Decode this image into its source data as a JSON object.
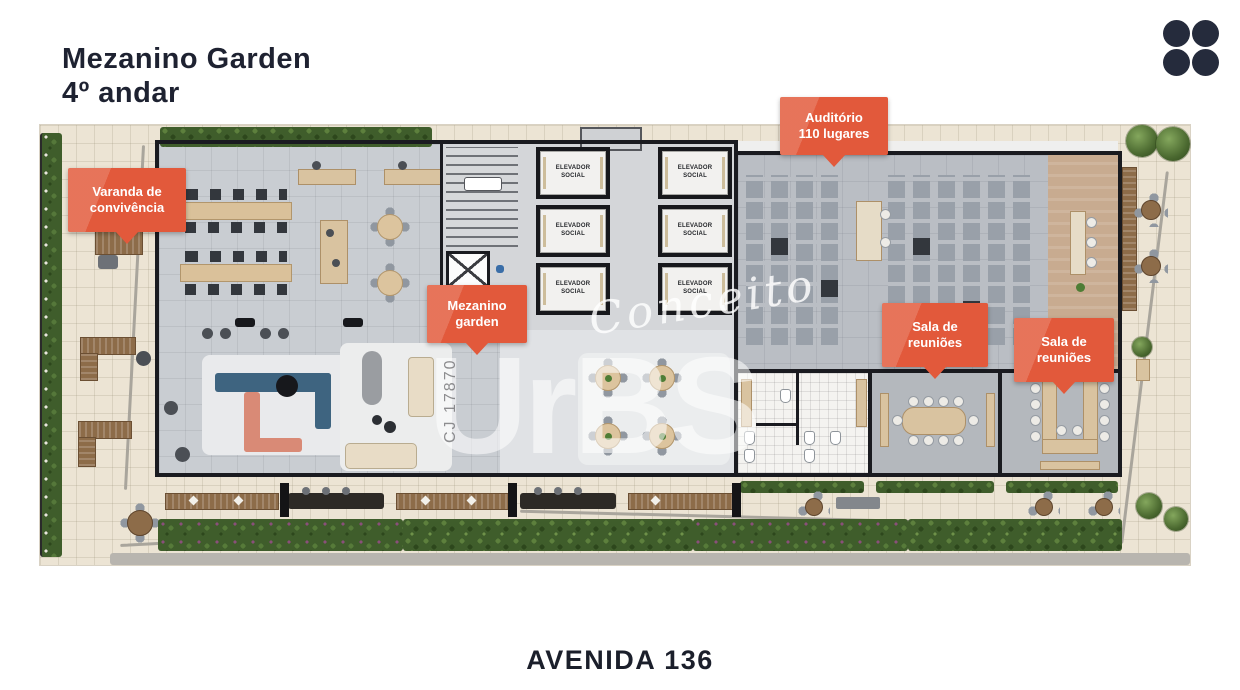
{
  "header": {
    "title_line1": "Mezanino Garden",
    "title_line2": "4º andar"
  },
  "footer": {
    "street": "AVENIDA 136"
  },
  "callouts": [
    {
      "line1": "Varanda de",
      "line2": "convivência"
    },
    {
      "line1": "Auditório",
      "line2": "110 lugares"
    },
    {
      "line1": "Mezanino",
      "line2": "garden"
    },
    {
      "line1": "Sala de",
      "line2": "reuniões"
    },
    {
      "line1": "Sala de",
      "line2": "reuniões"
    }
  ],
  "elevators": [
    {
      "line1": "ELEVADOR",
      "line2": "SOCIAL"
    },
    {
      "line1": "ELEVADOR",
      "line2": "SOCIAL"
    },
    {
      "line1": "ELEVADOR",
      "line2": "SOCIAL"
    },
    {
      "line1": "ELEVADOR",
      "line2": "SOCIAL"
    },
    {
      "line1": "ELEVADOR",
      "line2": "SOCIAL"
    },
    {
      "line1": "ELEVADOR",
      "line2": "SOCIAL"
    }
  ],
  "watermark": {
    "script": "Conceito",
    "brand": "UrBS",
    "registered": "®",
    "license": "CJ 17870"
  },
  "colors": {
    "accent_orange": "#e2593b",
    "ink_navy": "#1e2231",
    "wall_black": "#1a1b20"
  }
}
